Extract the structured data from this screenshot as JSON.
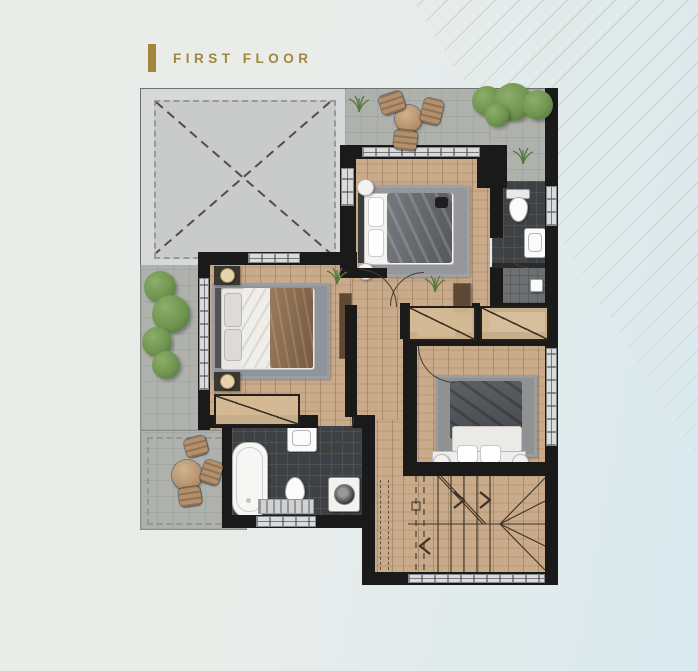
{
  "header": {
    "title": "FIRST FLOOR"
  },
  "colors": {
    "accent": "#a1873e",
    "bg-left": "#eaecea",
    "bg-right": "#d9eaee",
    "wall": "#1a1a1a",
    "wood": "#c9ab8b",
    "wood-light": "#d4b896",
    "tile-dark": "#3f4245",
    "shower": "#6d7072",
    "pavement": "#afb1ad",
    "void-outer": "#d7d9d8",
    "void-inner": "#c9cbca",
    "green-dark": "#4d6c3b",
    "green": "#6f9551",
    "green-light": "#8cae68",
    "rug": "#95979a",
    "fixture": "#fbfbfb",
    "brown": "#5d4834",
    "tan": "#b3906b",
    "window": "#d9dbdc",
    "line": "#4a3b2b"
  },
  "plan": {
    "floor_label": "FIRST FLOOR",
    "rooms": [
      {
        "id": "roof-void",
        "type": "open-area-dashed-x"
      },
      {
        "id": "terrace-top",
        "type": "terrace",
        "furniture": [
          "round-table",
          "chair",
          "chair",
          "chair"
        ],
        "planting": [
          "bushes",
          "grass"
        ]
      },
      {
        "id": "bedroom-1",
        "type": "bedroom",
        "furniture": [
          "double-bed",
          "rug",
          "pouf",
          "pouf",
          "dresser"
        ]
      },
      {
        "id": "bathroom-1",
        "type": "bathroom",
        "fixtures": [
          "toilet",
          "washbasin",
          "shower"
        ]
      },
      {
        "id": "master-bedroom",
        "type": "bedroom",
        "furniture": [
          "double-bed",
          "nightstand",
          "nightstand",
          "rug",
          "wardrobe",
          "closet"
        ]
      },
      {
        "id": "hallway",
        "type": "hall",
        "furniture": [
          "wardrobe",
          "wardrobe",
          "console"
        ]
      },
      {
        "id": "bedroom-2",
        "type": "bedroom",
        "furniture": [
          "double-bed",
          "rug",
          "bench",
          "pillows"
        ]
      },
      {
        "id": "bathroom-2",
        "type": "bathroom",
        "fixtures": [
          "bathtub",
          "washbasin",
          "toilet",
          "washing-machine",
          "bath-mat"
        ]
      },
      {
        "id": "terrace-left",
        "type": "terrace",
        "planting": [
          "bushes"
        ]
      },
      {
        "id": "terrace-bottom-left",
        "type": "terrace",
        "furniture": [
          "round-table",
          "chair",
          "chair",
          "chair"
        ]
      },
      {
        "id": "staircase",
        "type": "u-stair-with-arrows"
      }
    ]
  }
}
